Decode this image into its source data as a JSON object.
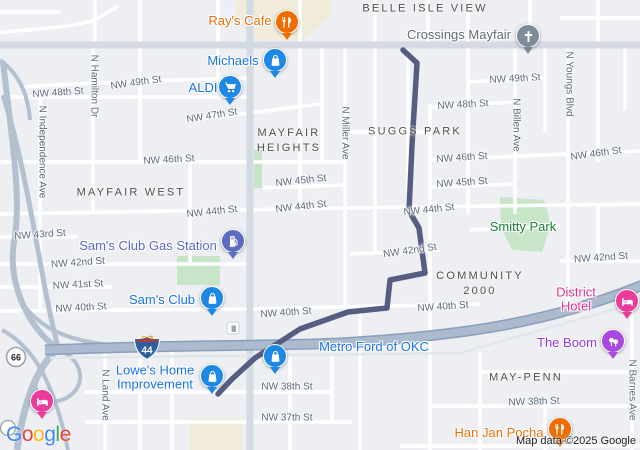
{
  "colors": {
    "route": "#565d82",
    "highway_fill": "#abbacf",
    "highway_casing": "#8a9fba",
    "land": "#edeff3",
    "park_green": "#c7e6c8",
    "commercial_cream": "#f1ecd9",
    "street_label": "#5a6a7d",
    "poi_blue": "#1a73e8",
    "poi_orange": "#e8710a"
  },
  "attribution": {
    "logo": "Google",
    "logo_colors": [
      "#4285F4",
      "#EA4335",
      "#FBBC05",
      "#4285F4",
      "#34A853",
      "#EA4335"
    ],
    "map_data_text": "Map data ©2025 Google"
  },
  "map": {
    "shields": {
      "i44": "44",
      "us66": "66"
    },
    "neighborhoods": [
      {
        "id": "belle-isle-view",
        "lines": [
          "BELLE ISLE VIEW"
        ],
        "x": 425,
        "y": 9
      },
      {
        "id": "mayfair-heights",
        "lines": [
          "MAYFAIR",
          "HEIGHTS"
        ],
        "x": 289,
        "y": 141
      },
      {
        "id": "suggs-park",
        "lines": [
          "SUGGS PARK"
        ],
        "x": 415,
        "y": 132
      },
      {
        "id": "mayfair-west",
        "lines": [
          "MAYFAIR WEST"
        ],
        "x": 131,
        "y": 193
      },
      {
        "id": "community-2000",
        "lines": [
          "COMMUNITY",
          "2000"
        ],
        "x": 480,
        "y": 284
      },
      {
        "id": "may-penn",
        "lines": [
          "MAY-PENN"
        ],
        "x": 526,
        "y": 378
      }
    ],
    "street_labels": [
      {
        "text": "NW 48th St",
        "x": 58,
        "y": 93,
        "rot": -4
      },
      {
        "text": "NW 49th St",
        "x": 136,
        "y": 83,
        "rot": -8
      },
      {
        "text": "NW 47th St",
        "x": 212,
        "y": 116,
        "rot": -9
      },
      {
        "text": "NW 46th St",
        "x": 169,
        "y": 160,
        "rot": -3
      },
      {
        "text": "NW 45th St",
        "x": 301,
        "y": 181,
        "rot": -6
      },
      {
        "text": "NW 44th St",
        "x": 212,
        "y": 212,
        "rot": -6
      },
      {
        "text": "NW 44th St",
        "x": 301,
        "y": 207,
        "rot": -6
      },
      {
        "text": "NW 43rd St",
        "x": 40,
        "y": 235,
        "rot": -4
      },
      {
        "text": "NW 42nd St",
        "x": 78,
        "y": 263,
        "rot": -4
      },
      {
        "text": "NW 41st St",
        "x": 78,
        "y": 285,
        "rot": -3
      },
      {
        "text": "NW 40th St",
        "x": 81,
        "y": 308,
        "rot": -3
      },
      {
        "text": "NW 40th St",
        "x": 286,
        "y": 313,
        "rot": -4
      },
      {
        "text": "NW 38th St",
        "x": 287,
        "y": 387,
        "rot": 0
      },
      {
        "text": "NW 37th St",
        "x": 287,
        "y": 418,
        "rot": 0
      },
      {
        "text": "NW 49th St",
        "x": 515,
        "y": 79,
        "rot": -3
      },
      {
        "text": "NW 48th St",
        "x": 463,
        "y": 105,
        "rot": -3
      },
      {
        "text": "NW 46th St",
        "x": 462,
        "y": 158,
        "rot": -4
      },
      {
        "text": "NW 45th St",
        "x": 462,
        "y": 183,
        "rot": -4
      },
      {
        "text": "NW 44th St",
        "x": 429,
        "y": 210,
        "rot": -6
      },
      {
        "text": "NW 42nd St",
        "x": 410,
        "y": 251,
        "rot": -8
      },
      {
        "text": "NW 46th St",
        "x": 596,
        "y": 154,
        "rot": -8
      },
      {
        "text": "NW 42nd St",
        "x": 601,
        "y": 258,
        "rot": -4
      },
      {
        "text": "NW 40th St",
        "x": 443,
        "y": 307,
        "rot": -4
      },
      {
        "text": "NW 38th St",
        "x": 534,
        "y": 402,
        "rot": -2
      },
      {
        "text": "N Independence Ave",
        "x": 42,
        "y": 152,
        "vertical": true
      },
      {
        "text": "N Hamilton Dr",
        "x": 94,
        "y": 86,
        "vertical": true
      },
      {
        "text": "N Miller Ave",
        "x": 345,
        "y": 133,
        "vertical": true
      },
      {
        "text": "N Billen Ave",
        "x": 516,
        "y": 125,
        "vertical": true
      },
      {
        "text": "N Youngs Blvd",
        "x": 569,
        "y": 84,
        "vertical": true
      },
      {
        "text": "N Land Ave",
        "x": 105,
        "y": 395,
        "vertical": true
      },
      {
        "text": "N Barnes Ave",
        "x": 632,
        "y": 390,
        "vertical": true
      }
    ],
    "pois": [
      {
        "id": "rays-cafe",
        "label": [
          "Ray's Cafe"
        ],
        "color": "#e8710a",
        "lx": 240,
        "ly": 21,
        "pin": {
          "x": 287,
          "y": 23,
          "color": "#ef6c00",
          "icon": "restaurant"
        }
      },
      {
        "id": "crossings-mayfair",
        "label": [
          "Crossings Mayfair"
        ],
        "color": "#646b75",
        "lx": 459,
        "ly": 35,
        "pin": {
          "x": 528,
          "y": 37,
          "color": "#7e8b99",
          "icon": "cross"
        }
      },
      {
        "id": "michaels",
        "label": [
          "Michaels"
        ],
        "color": "#1a73e8",
        "lx": 233,
        "ly": 61,
        "pin": {
          "x": 275,
          "y": 61,
          "color": "#1e88e5",
          "icon": "bag"
        }
      },
      {
        "id": "aldi",
        "label": [
          "ALDI"
        ],
        "color": "#1a73e8",
        "lx": 203,
        "ly": 88,
        "pin": {
          "x": 230,
          "y": 88,
          "color": "#1e88e5",
          "icon": "cart"
        }
      },
      {
        "id": "sams-club-gas-station",
        "label": [
          "Sam's Club Gas Station"
        ],
        "color": "#5b68d0",
        "lx": 148,
        "ly": 246,
        "pin": {
          "x": 233,
          "y": 242,
          "color": "#5c6bc0",
          "icon": "gas"
        }
      },
      {
        "id": "sams-club",
        "label": [
          "Sam's Club"
        ],
        "color": "#1a73e8",
        "lx": 162,
        "ly": 300,
        "pin": {
          "x": 212,
          "y": 299,
          "color": "#1e88e5",
          "icon": "bag"
        }
      },
      {
        "id": "lowes-home-improvement",
        "label": [
          "Lowe's Home",
          "Improvement"
        ],
        "color": "#1a73e8",
        "lx": 155,
        "ly": 378,
        "pin": {
          "x": 212,
          "y": 377,
          "color": "#1e88e5",
          "icon": "bag"
        }
      },
      {
        "id": "metro-ford-of-okc",
        "label": [
          "Metro Ford of OKC"
        ],
        "color": "#1a73e8",
        "lx": 374,
        "ly": 347,
        "pin": {
          "x": 275,
          "y": 357,
          "color": "#1e88e5",
          "icon": "bag"
        }
      },
      {
        "id": "smitty-park",
        "label": [
          "Smitty Park"
        ],
        "color": "#188038",
        "lx": 523,
        "ly": 227,
        "pin": null
      },
      {
        "id": "district-hotel",
        "label": [
          "District Hotel"
        ],
        "color": "#e5338e",
        "lx": 576,
        "ly": 300,
        "pin": {
          "x": 627,
          "y": 302,
          "color": "#ec3b9a",
          "icon": "bed"
        }
      },
      {
        "id": "the-boom",
        "label": [
          "The Boom"
        ],
        "color": "#9334e6",
        "lx": 567,
        "ly": 343,
        "pin": {
          "x": 613,
          "y": 342,
          "color": "#a64ae0",
          "icon": "drink"
        }
      },
      {
        "id": "han-jan-pocha",
        "label": [
          "Han Jan Pocha"
        ],
        "color": "#e8710a",
        "lx": 499,
        "ly": 433,
        "pin": {
          "x": 560,
          "y": 430,
          "color": "#ef6c00",
          "icon": "restaurant"
        }
      },
      {
        "id": "hotel-west",
        "label": [],
        "color": "",
        "lx": 0,
        "ly": 0,
        "pin": {
          "x": 42,
          "y": 402,
          "color": "#ec3b9a",
          "icon": "bed"
        }
      }
    ]
  }
}
